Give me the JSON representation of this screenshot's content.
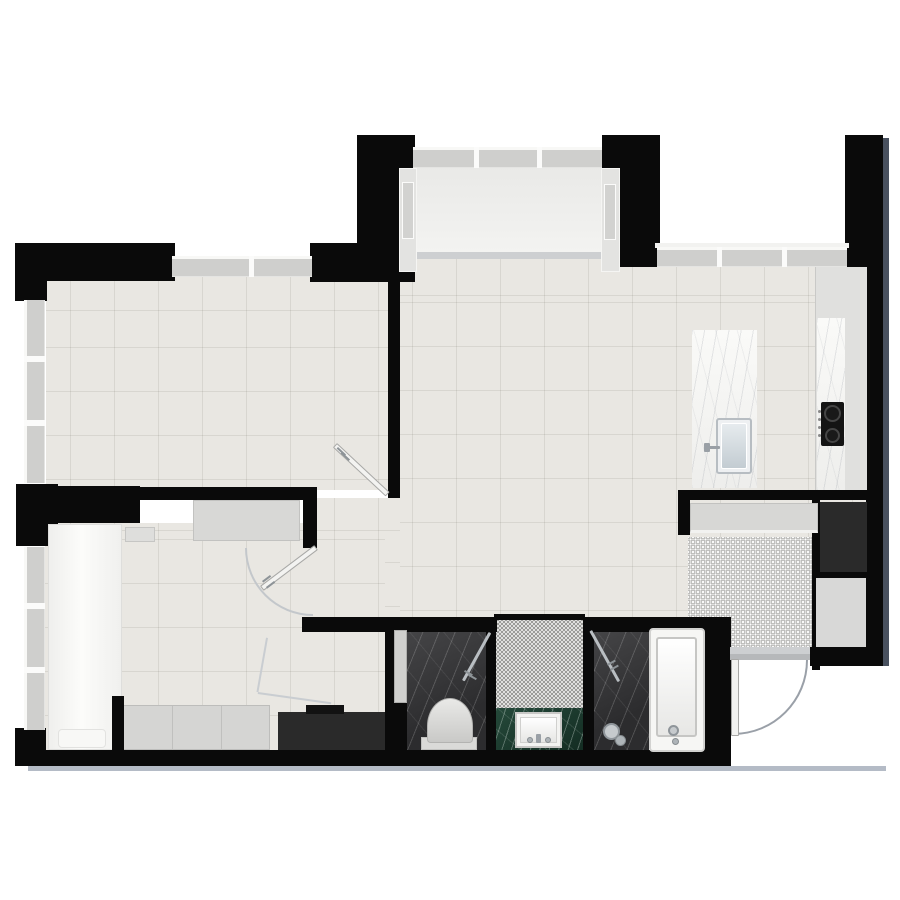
{
  "meta": {
    "description": "rendered-apartment-floor-plan",
    "canvas": {
      "width": 900,
      "height": 900
    }
  },
  "palette": {
    "wall": "#0a0a0a",
    "floor_tile": "#e9e7e2",
    "bay_floor": "#f1f1ef",
    "dark_marble": "#353537",
    "green_marble": "#1d3c2e",
    "white_marble": "#f6f6f4",
    "mosaic_base": "#eeeeec",
    "window_pane": "#cfcfcd",
    "exterior_shadow_bottom": "#b4bbc6",
    "exterior_shadow_right": "#49515f"
  },
  "rooms": [
    {
      "name": "top-left-room"
    },
    {
      "name": "living-kitchen-area"
    },
    {
      "name": "bay-window-nook"
    },
    {
      "name": "bedroom"
    },
    {
      "name": "wc"
    },
    {
      "name": "vanity-niche"
    },
    {
      "name": "shower"
    },
    {
      "name": "bathtub-zone"
    },
    {
      "name": "entry-foyer"
    }
  ],
  "elements": [
    {
      "n": "bottom-exterior-shadow",
      "c": "shadow-b",
      "x": 28,
      "y": 766,
      "w": 858,
      "h": 5
    },
    {
      "n": "right-exterior-shadow",
      "c": "shadow-r",
      "x": 883,
      "y": 138,
      "w": 6,
      "h": 528
    },
    {
      "n": "top-left-room-floor",
      "c": "floor",
      "x": 46,
      "y": 277,
      "w": 342,
      "h": 213,
      "bp": "24px 34px"
    },
    {
      "n": "living-kitchen-floor",
      "c": "floor",
      "x": 400,
      "y": 258,
      "w": 467,
      "h": 359,
      "bp": "12px 38px"
    },
    {
      "n": "hall-strip-floor",
      "c": "floor",
      "x": 317,
      "y": 498,
      "w": 83,
      "h": 120,
      "bp": "17px 33px"
    },
    {
      "n": "bedroom-floor",
      "c": "floor",
      "x": 45,
      "y": 523,
      "w": 340,
      "h": 229,
      "bp": "25px 8px"
    },
    {
      "n": "bay-threshold",
      "c": "threshold",
      "x": 413,
      "y": 252,
      "w": 189,
      "h": 7
    },
    {
      "n": "bay-window-floor",
      "c": "f-bay",
      "x": 415,
      "y": 166,
      "w": 187,
      "h": 86
    },
    {
      "n": "foyer-mosaic-floor",
      "c": "f-mosaic-l",
      "x": 688,
      "y": 537,
      "w": 124,
      "h": 111
    },
    {
      "n": "wc-floor",
      "c": "marble-dark",
      "x": 407,
      "y": 630,
      "w": 79,
      "h": 121
    },
    {
      "n": "vanity-mosaic-floor",
      "c": "f-mosaic-d",
      "x": 496,
      "y": 620,
      "w": 87,
      "h": 88
    },
    {
      "n": "vanity-counter",
      "c": "marble-green",
      "x": 496,
      "y": 708,
      "w": 87,
      "h": 44
    },
    {
      "n": "shower-floor",
      "c": "marble-dark",
      "x": 594,
      "y": 630,
      "w": 55,
      "h": 121
    },
    {
      "n": "top-left-exterior-wall-h",
      "c": "wall",
      "x": 15,
      "y": 243,
      "w": 160,
      "h": 38
    },
    {
      "n": "top-left-exterior-wall-v",
      "c": "wall",
      "x": 15,
      "y": 243,
      "w": 32,
      "h": 58
    },
    {
      "n": "top-wall-segment",
      "c": "wall",
      "x": 310,
      "y": 243,
      "w": 50,
      "h": 39
    },
    {
      "n": "bay-left-flank-wall",
      "c": "wall",
      "x": 357,
      "y": 135,
      "w": 58,
      "h": 147
    },
    {
      "n": "bay-right-flank-wall",
      "c": "wall",
      "x": 602,
      "y": 135,
      "w": 58,
      "h": 132
    },
    {
      "n": "top-right-corner-wall",
      "c": "wall",
      "x": 845,
      "y": 135,
      "w": 38,
      "h": 132
    },
    {
      "n": "right-exterior-wall",
      "c": "wall",
      "x": 866,
      "y": 267,
      "w": 17,
      "h": 399
    },
    {
      "n": "left-mid-wall-block",
      "c": "wall",
      "x": 16,
      "y": 484,
      "w": 42,
      "h": 62
    },
    {
      "n": "room-divider-wall",
      "c": "wall",
      "x": 388,
      "y": 282,
      "w": 12,
      "h": 216
    },
    {
      "n": "bed-head-wall",
      "c": "wall",
      "x": 40,
      "y": 486,
      "w": 100,
      "h": 37
    },
    {
      "n": "bedroom-top-wall",
      "c": "wall",
      "x": 140,
      "y": 487,
      "w": 177,
      "h": 13
    },
    {
      "n": "bedroom-door-stub-wall",
      "c": "wall",
      "x": 303,
      "y": 488,
      "w": 14,
      "h": 60
    },
    {
      "n": "left-bottom-corner-wall",
      "c": "wall",
      "x": 15,
      "y": 728,
      "w": 31,
      "h": 38
    },
    {
      "n": "bottom-exterior-wall",
      "c": "wall",
      "x": 15,
      "y": 750,
      "w": 716,
      "h": 16
    },
    {
      "n": "bath-top-wall-left",
      "c": "wall",
      "x": 302,
      "y": 617,
      "w": 195,
      "h": 15
    },
    {
      "n": "bath-top-wall-right",
      "c": "wall",
      "x": 583,
      "y": 617,
      "w": 130,
      "h": 15
    },
    {
      "n": "vanity-top-wall-line",
      "c": "wall",
      "x": 494,
      "y": 614,
      "w": 91,
      "h": 6
    },
    {
      "n": "bath-left-wall",
      "c": "wall",
      "x": 385,
      "y": 617,
      "w": 9,
      "h": 136
    },
    {
      "n": "bath-left-lower-wall",
      "c": "wall",
      "x": 394,
      "y": 703,
      "w": 13,
      "h": 50
    },
    {
      "n": "bath-divider-wall-a",
      "c": "wall",
      "x": 486,
      "y": 630,
      "w": 10,
      "h": 121
    },
    {
      "n": "bath-divider-wall-b",
      "c": "wall",
      "x": 583,
      "y": 620,
      "w": 11,
      "h": 131
    },
    {
      "n": "entry-left-jamb-wall",
      "c": "wall",
      "x": 703,
      "y": 617,
      "w": 28,
      "h": 149
    },
    {
      "n": "entry-top-wall",
      "c": "wall",
      "x": 678,
      "y": 490,
      "w": 205,
      "h": 10
    },
    {
      "n": "entry-stub-wall",
      "c": "wall",
      "x": 678,
      "y": 490,
      "w": 12,
      "h": 45
    },
    {
      "n": "entry-bottom-wall-block",
      "c": "wall",
      "x": 810,
      "y": 647,
      "w": 73,
      "h": 19
    },
    {
      "n": "entry-inner-wall",
      "c": "wall",
      "x": 812,
      "y": 500,
      "w": 8,
      "h": 170
    },
    {
      "n": "niche-top-wall",
      "c": "wall",
      "x": 812,
      "y": 570,
      "w": 55,
      "h": 10
    },
    {
      "n": "foyer-niche-floor",
      "c": "f-gray",
      "x": 816,
      "y": 578,
      "w": 50,
      "h": 69
    },
    {
      "n": "top-window",
      "c": "win",
      "x": 172,
      "y": 256,
      "w": 140,
      "h": 21
    },
    {
      "n": "top-window-mullion",
      "c": "mull",
      "x": 249,
      "y": 256,
      "w": 5,
      "h": 21
    },
    {
      "n": "left-window-upper",
      "c": "win-v",
      "x": 24,
      "y": 300,
      "w": 21,
      "h": 183
    },
    {
      "n": "left-window-upper-mullion-1",
      "c": "mull",
      "x": 24,
      "y": 356,
      "w": 21,
      "h": 6
    },
    {
      "n": "left-window-upper-mullion-2",
      "c": "mull",
      "x": 24,
      "y": 420,
      "w": 21,
      "h": 6
    },
    {
      "n": "left-window-lower",
      "c": "win-v",
      "x": 24,
      "y": 547,
      "w": 21,
      "h": 183
    },
    {
      "n": "left-window-lower-mullion-1",
      "c": "mull",
      "x": 24,
      "y": 603,
      "w": 21,
      "h": 6
    },
    {
      "n": "left-window-lower-mullion-2",
      "c": "mull",
      "x": 24,
      "y": 667,
      "w": 21,
      "h": 6
    },
    {
      "n": "bay-top-window",
      "c": "win",
      "x": 413,
      "y": 147,
      "w": 189,
      "h": 21
    },
    {
      "n": "bay-top-window-mullion-1",
      "c": "mull",
      "x": 474,
      "y": 147,
      "w": 5,
      "h": 21
    },
    {
      "n": "bay-top-window-mullion-2",
      "c": "mull",
      "x": 537,
      "y": 147,
      "w": 5,
      "h": 21
    },
    {
      "n": "bay-side-band-left",
      "c": "sideband",
      "x": 399,
      "y": 168,
      "w": 18,
      "h": 104
    },
    {
      "n": "bay-side-pane-left",
      "c": "sidepane",
      "x": 402,
      "y": 182,
      "w": 12,
      "h": 57
    },
    {
      "n": "bay-side-band-right",
      "c": "sideband",
      "x": 601,
      "y": 168,
      "w": 19,
      "h": 104
    },
    {
      "n": "bay-side-pane-right",
      "c": "sidepane",
      "x": 604,
      "y": 184,
      "w": 12,
      "h": 56
    },
    {
      "n": "kitchen-window-sill",
      "c": "sill",
      "x": 655,
      "y": 243,
      "w": 194,
      "h": 5
    },
    {
      "n": "kitchen-top-window",
      "c": "win",
      "x": 657,
      "y": 247,
      "w": 190,
      "h": 20
    },
    {
      "n": "kitchen-window-mullion-1",
      "c": "mull",
      "x": 717,
      "y": 247,
      "w": 5,
      "h": 20
    },
    {
      "n": "kitchen-window-mullion-2",
      "c": "mull",
      "x": 782,
      "y": 247,
      "w": 5,
      "h": 20
    },
    {
      "n": "kitchen-counter",
      "c": "counter",
      "x": 815,
      "y": 267,
      "w": 52,
      "h": 223
    },
    {
      "n": "kitchen-counter-marble",
      "c": "marble-w",
      "x": 817,
      "y": 318,
      "w": 28,
      "h": 172
    },
    {
      "n": "cooktop",
      "c": "cooktop",
      "x": 821,
      "y": 402,
      "w": 23,
      "h": 44
    },
    {
      "n": "cooktop-burner-large",
      "c": "burner",
      "x": 824,
      "y": 405,
      "w": 17,
      "h": 17
    },
    {
      "n": "cooktop-burner-small",
      "c": "burner",
      "x": 825,
      "y": 428,
      "w": 15,
      "h": 15
    },
    {
      "n": "cooktop-knob-1",
      "c": "knob",
      "x": 818,
      "y": 410,
      "w": 3,
      "h": 3
    },
    {
      "n": "cooktop-knob-2",
      "c": "knob",
      "x": 818,
      "y": 418,
      "w": 3,
      "h": 3
    },
    {
      "n": "cooktop-knob-3",
      "c": "knob",
      "x": 818,
      "y": 426,
      "w": 3,
      "h": 3
    },
    {
      "n": "cooktop-knob-4",
      "c": "knob",
      "x": 818,
      "y": 434,
      "w": 3,
      "h": 3
    },
    {
      "n": "kitchen-island",
      "c": "marble-w",
      "x": 692,
      "y": 330,
      "w": 65,
      "h": 158
    },
    {
      "n": "island-sink-rim",
      "c": "sink-out",
      "x": 716,
      "y": 418,
      "w": 36,
      "h": 56
    },
    {
      "n": "island-sink-basin",
      "c": "sink-in",
      "x": 721,
      "y": 423,
      "w": 26,
      "h": 46
    },
    {
      "n": "island-faucet-base",
      "c": "faucet",
      "x": 704,
      "y": 443,
      "w": 6,
      "h": 9
    },
    {
      "n": "island-faucet-spout",
      "c": "faucet",
      "x": 708,
      "y": 446,
      "w": 12,
      "h": 3
    },
    {
      "n": "entry-closet",
      "c": "closet",
      "x": 690,
      "y": 503,
      "w": 128,
      "h": 30
    },
    {
      "n": "entry-tall-cabinet",
      "c": "cab-dark",
      "x": 820,
      "y": 502,
      "w": 47,
      "h": 70
    },
    {
      "n": "entry-threshold-outer",
      "c": "threshold",
      "x": 730,
      "y": 647,
      "w": 80,
      "h": 7
    },
    {
      "n": "entry-threshold-inner",
      "c": "threshold2",
      "x": 730,
      "y": 654,
      "w": 80,
      "h": 6
    },
    {
      "n": "bed",
      "c": "bed",
      "x": 48,
      "y": 524,
      "w": 74,
      "h": 226
    },
    {
      "n": "bed-pillow",
      "c": "pillow",
      "x": 58,
      "y": 729,
      "w": 48,
      "h": 19
    },
    {
      "n": "nightstand",
      "c": "nightstand",
      "x": 125,
      "y": 527,
      "w": 30,
      "h": 15
    },
    {
      "n": "dresser",
      "c": "dresser",
      "x": 193,
      "y": 500,
      "w": 107,
      "h": 41
    },
    {
      "n": "wardrobe",
      "c": "wardrobe",
      "x": 123,
      "y": 705,
      "w": 147,
      "h": 45
    },
    {
      "n": "bedroom-wall-stub",
      "c": "wall",
      "x": 112,
      "y": 696,
      "w": 12,
      "h": 56
    },
    {
      "n": "bedroom-dark-cabinet",
      "c": "cab-dark",
      "x": 278,
      "y": 712,
      "w": 107,
      "h": 38
    },
    {
      "n": "bedroom-dark-cabinet-top",
      "c": "cab-darker",
      "x": 306,
      "y": 705,
      "w": 38,
      "h": 9
    },
    {
      "n": "wc-pocket-door",
      "c": "pocket",
      "x": 394,
      "y": 630,
      "w": 13,
      "h": 73
    },
    {
      "n": "toilet-base",
      "c": "toilet-base",
      "x": 421,
      "y": 737,
      "w": 56,
      "h": 13
    },
    {
      "n": "toilet-bowl",
      "c": "toilet",
      "x": 427,
      "y": 698,
      "w": 46,
      "h": 45
    },
    {
      "n": "vanity-sink-rim",
      "c": "vsink-out",
      "x": 515,
      "y": 712,
      "w": 47,
      "h": 36
    },
    {
      "n": "vanity-sink-basin",
      "c": "vsink-in",
      "x": 520,
      "y": 717,
      "w": 37,
      "h": 26
    },
    {
      "n": "vanity-faucet-handle-left",
      "c": "shead2",
      "x": 527,
      "y": 737,
      "w": 6,
      "h": 6
    },
    {
      "n": "vanity-faucet-spout",
      "c": "faucet",
      "x": 536,
      "y": 734,
      "w": 5,
      "h": 9
    },
    {
      "n": "vanity-faucet-handle-right",
      "c": "shead2",
      "x": 545,
      "y": 737,
      "w": 6,
      "h": 6
    },
    {
      "n": "hand-shower-head",
      "c": "shead",
      "x": 603,
      "y": 723,
      "w": 17,
      "h": 17
    },
    {
      "n": "hand-shower-knob",
      "c": "shead2",
      "x": 615,
      "y": 735,
      "w": 11,
      "h": 11
    },
    {
      "n": "bathtub",
      "c": "tub",
      "x": 649,
      "y": 628,
      "w": 56,
      "h": 124
    },
    {
      "n": "bathtub-basin",
      "c": "tub-in",
      "x": 656,
      "y": 637,
      "w": 41,
      "h": 100
    },
    {
      "n": "bathtub-faucet",
      "c": "shead",
      "x": 668,
      "y": 725,
      "w": 11,
      "h": 11
    },
    {
      "n": "bathtub-faucet-knob",
      "c": "shead2",
      "x": 672,
      "y": 738,
      "w": 7,
      "h": 7
    },
    {
      "n": "top-left-room-door-leaf",
      "c": "leaf",
      "x": 337,
      "y": 443,
      "w": 72,
      "h": 6,
      "r": 43
    },
    {
      "n": "top-left-room-door-handle-1",
      "c": "tick",
      "x": 338,
      "y": 447,
      "w": 11,
      "h": 2,
      "r": 43
    },
    {
      "n": "top-left-room-door-handle-2",
      "c": "tick",
      "x": 342,
      "y": 452,
      "w": 11,
      "h": 2,
      "r": 43
    },
    {
      "n": "bedroom-door-swing-arc",
      "c": "arc-bl",
      "x": 245,
      "y": 548,
      "w": 68,
      "h": 68
    },
    {
      "n": "bedroom-door-leaf",
      "c": "leaf",
      "x": 260,
      "y": 586,
      "w": 68,
      "h": 6,
      "r": -37
    },
    {
      "n": "bedroom-door-handle-1",
      "c": "tick",
      "x": 262,
      "y": 581,
      "w": 10,
      "h": 2,
      "r": -37
    },
    {
      "n": "bedroom-door-handle-2",
      "c": "tick",
      "x": 266,
      "y": 587,
      "w": 10,
      "h": 2,
      "r": -37
    },
    {
      "n": "hall-door-swing-line-1",
      "c": "thin",
      "x": 268,
      "y": 638,
      "w": 55,
      "h": 2,
      "r": 100
    },
    {
      "n": "hall-door-swing-line-2",
      "c": "thin",
      "x": 258,
      "y": 692,
      "w": 74,
      "h": 2,
      "r": 8
    },
    {
      "n": "wc-glass-door",
      "c": "glass",
      "x": 462,
      "y": 680,
      "w": 55,
      "h": 3,
      "r": -61
    },
    {
      "n": "wc-glass-handle-1",
      "c": "tick",
      "x": 465,
      "y": 670,
      "w": 9,
      "h": 2,
      "r": 29
    },
    {
      "n": "wc-glass-handle-2",
      "c": "tick",
      "x": 469,
      "y": 674,
      "w": 9,
      "h": 2,
      "r": 29
    },
    {
      "n": "shower-glass-door",
      "c": "glass",
      "x": 592,
      "y": 630,
      "w": 58,
      "h": 3,
      "r": 61
    },
    {
      "n": "shower-glass-handle-1",
      "c": "tick",
      "x": 607,
      "y": 664,
      "w": 9,
      "h": 2,
      "r": -29
    },
    {
      "n": "shower-glass-handle-2",
      "c": "tick",
      "x": 610,
      "y": 669,
      "w": 9,
      "h": 2,
      "r": -29
    },
    {
      "n": "entry-door-swing-arc",
      "c": "arc-br",
      "x": 733,
      "y": 660,
      "w": 75,
      "h": 75
    },
    {
      "n": "entry-door-leaf",
      "c": "leaf",
      "x": 731,
      "y": 659,
      "w": 8,
      "h": 77
    }
  ]
}
